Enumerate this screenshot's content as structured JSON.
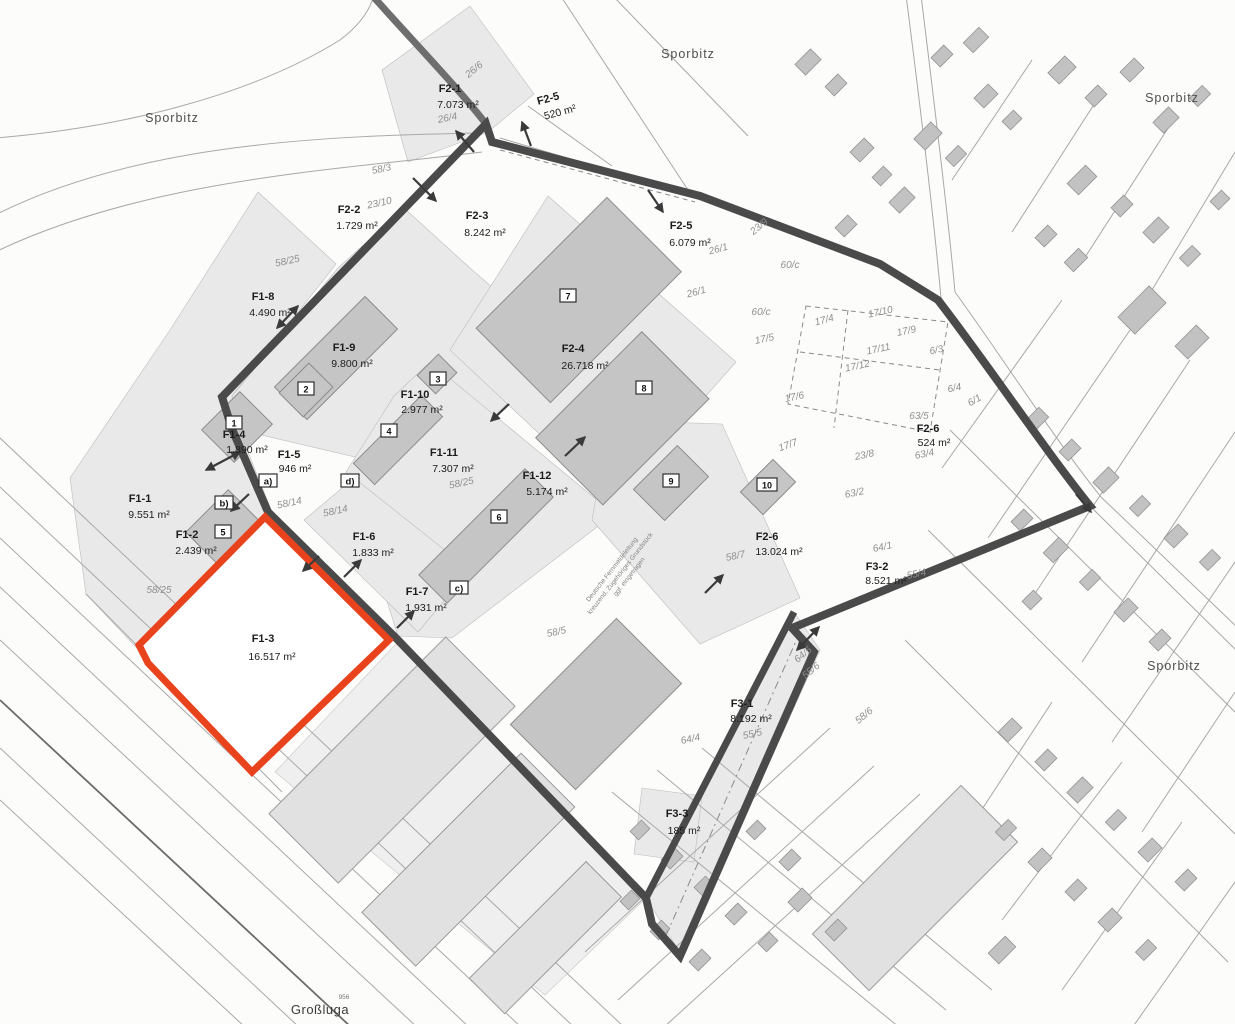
{
  "colors": {
    "highlight": "#e8431c",
    "boundary": "#4a4a4a",
    "zone_fill": "#e9e9e9",
    "building_fill": "#c5c5c5",
    "background": "#fcfcfb"
  },
  "district_labels": [
    {
      "text": "Sporbitz"
    },
    {
      "text": "Sporbitz"
    },
    {
      "text": "Sporbitz"
    },
    {
      "text": "Sporbitz"
    }
  ],
  "place_label": "Großluga",
  "tiny_label": "956",
  "parcels": [
    {
      "id": "F2-1",
      "area": "7.073 m²"
    },
    {
      "id": "F2-5",
      "area": "520 m²"
    },
    {
      "id": "F2-2",
      "area": "1.729 m²"
    },
    {
      "id": "F2-3",
      "area": "8.242 m²"
    },
    {
      "id": "F2-5",
      "area": "6.079 m²"
    },
    {
      "id": "F1-8",
      "area": "4.490 m²"
    },
    {
      "id": "F1-9",
      "area": "9.800 m²"
    },
    {
      "id": "F2-4",
      "area": "26.718 m²"
    },
    {
      "id": "F1-10",
      "area": "2.977 m²"
    },
    {
      "id": "F1-4",
      "area": "1.890 m²"
    },
    {
      "id": "F1-5",
      "area": "946 m²"
    },
    {
      "id": "F1-11",
      "area": "7.307 m²"
    },
    {
      "id": "F1-12",
      "area": "5.174 m²"
    },
    {
      "id": "F1-1",
      "area": "9.551 m²"
    },
    {
      "id": "F1-2",
      "area": "2.439 m²"
    },
    {
      "id": "F1-6",
      "area": "1.833 m²"
    },
    {
      "id": "F2-6",
      "area": "524 m²"
    },
    {
      "id": "F1-7",
      "area": "1.931 m²"
    },
    {
      "id": "F2-6",
      "area": "13.024 m²"
    },
    {
      "id": "F3-2",
      "area": "8.521 m²"
    },
    {
      "id": "F1-3",
      "area": "16.517 m²"
    },
    {
      "id": "F3-1",
      "area": "8.192 m²"
    },
    {
      "id": "F3-3",
      "area": "185 m²"
    }
  ],
  "lot_numbers": [
    {
      "text": "26/6"
    },
    {
      "text": "26/4"
    },
    {
      "text": "58/3"
    },
    {
      "text": "23/10"
    },
    {
      "text": "58/25"
    },
    {
      "text": "26/1"
    },
    {
      "text": "23/9"
    },
    {
      "text": "60/c"
    },
    {
      "text": "60/c"
    },
    {
      "text": "26/1"
    },
    {
      "text": "17/4"
    },
    {
      "text": "17/10"
    },
    {
      "text": "17/9"
    },
    {
      "text": "17/11"
    },
    {
      "text": "17/12"
    },
    {
      "text": "6/3"
    },
    {
      "text": "17/5"
    },
    {
      "text": "17/6"
    },
    {
      "text": "6/4"
    },
    {
      "text": "6/1"
    },
    {
      "text": "63/5"
    },
    {
      "text": "63/4"
    },
    {
      "text": "17/7"
    },
    {
      "text": "23/8"
    },
    {
      "text": "63/2"
    },
    {
      "text": "58/14"
    },
    {
      "text": "58/14"
    },
    {
      "text": "58/25"
    },
    {
      "text": "58/25"
    },
    {
      "text": "58/7"
    },
    {
      "text": "64/1"
    },
    {
      "text": "55/4"
    },
    {
      "text": "58/5"
    },
    {
      "text": "64/5"
    },
    {
      "text": "55/6"
    },
    {
      "text": "58/6"
    },
    {
      "text": "64/4"
    },
    {
      "text": "55/5"
    }
  ],
  "building_numbers": [
    "1",
    "2",
    "3",
    "4",
    "5",
    "6",
    "7",
    "8",
    "9",
    "10"
  ],
  "letter_markers": [
    "a)",
    "b)",
    "c)",
    "d)"
  ],
  "note_lines": [
    "Deutsche Fernmeldeleitung",
    "kreuzend, Zugehöriges Grundstück",
    "ggf. eingetragen"
  ]
}
